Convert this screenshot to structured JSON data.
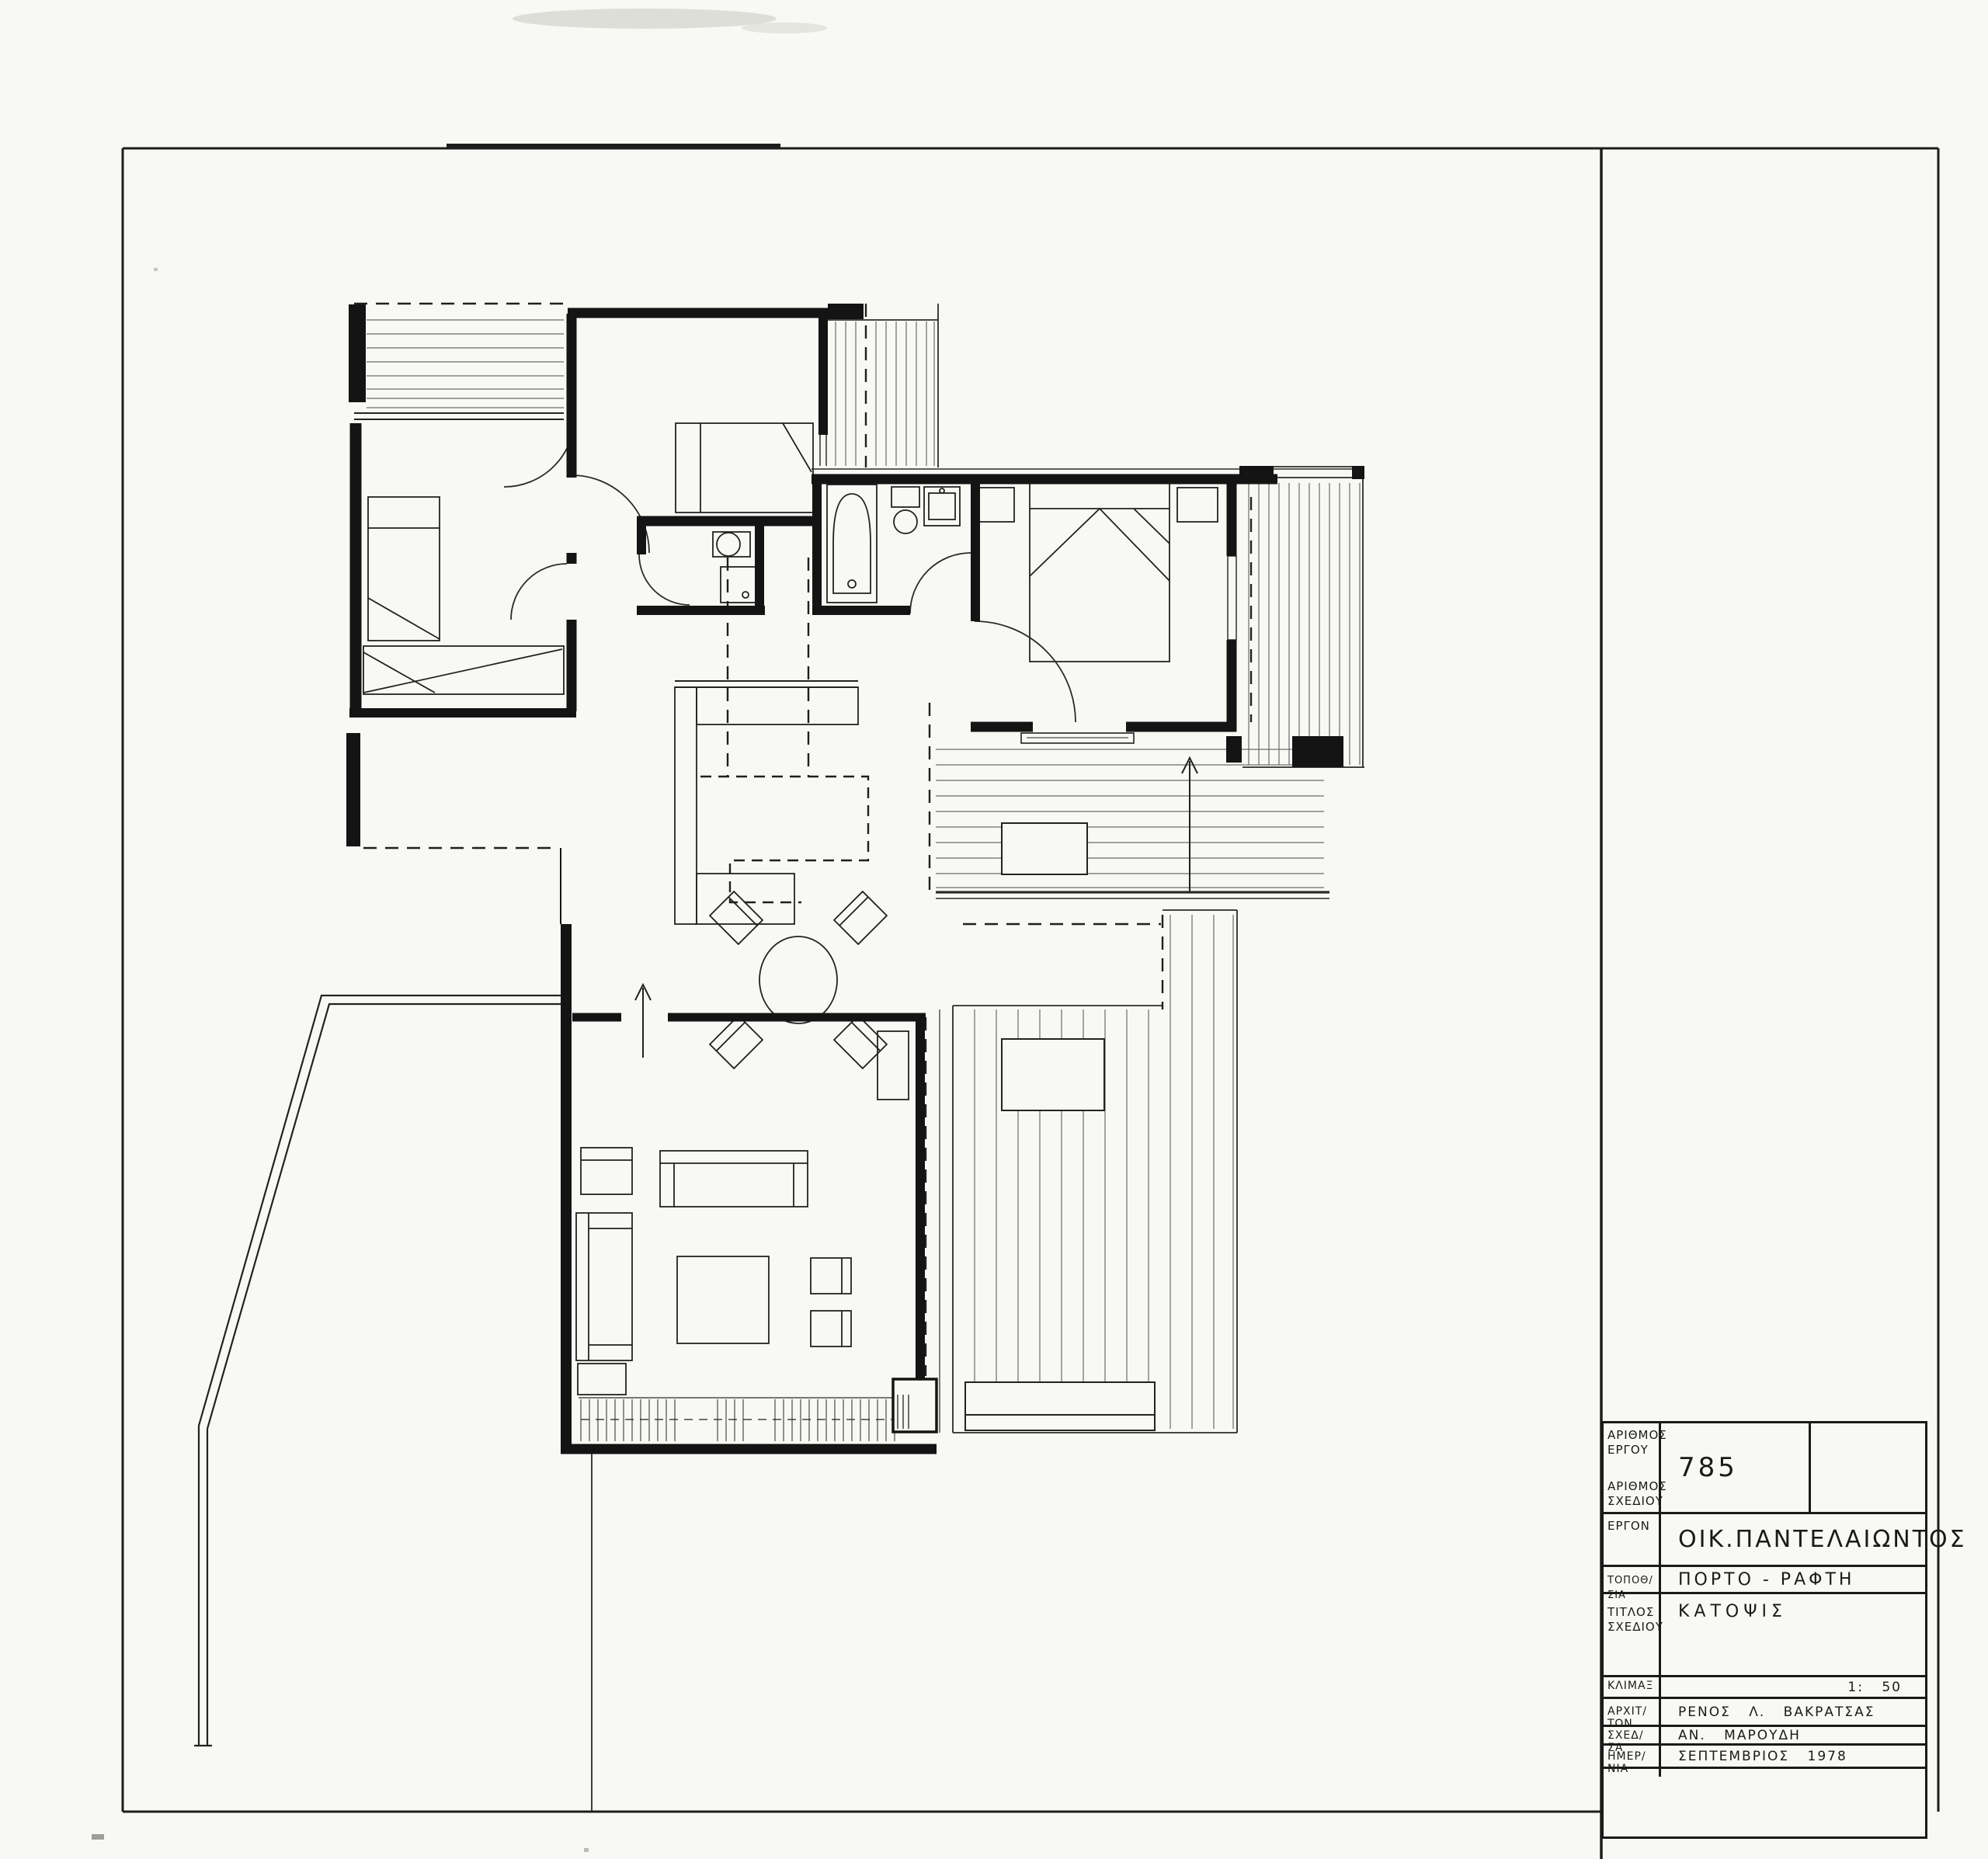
{
  "sheet": {
    "type_of_drawing": "architectural floor plan",
    "language": "Greek"
  },
  "colors": {
    "paper": "#f8f8f4",
    "ink": "#1a1a1a",
    "slat_line": "#6b6b6b"
  },
  "title_block": {
    "fields": [
      {
        "label_top": "ΑΡΙΘΜΟΣ ΕΡΓΟΥ",
        "label_bottom": "ΑΡΙΘΜΟΣ ΣΧΕΔΙΟΥ",
        "value": "785"
      },
      {
        "label": "ΕΡΓΟΝ",
        "value": "ΟΙΚ.ΠΑΝΤΕΛΑΙΩΝΤΟΣ"
      },
      {
        "label": "ΤΟΠΟΘ/ΣΙΑ",
        "value": "ΠΟΡΤΟ - ΡΑΦΤΗ"
      },
      {
        "label": "ΤΙΤΛΟΣ ΣΧΕΔΙΟΥ",
        "value": "ΚΑΤΟΨΙΣ"
      },
      {
        "label": "ΚΛΙΜΑΞ",
        "value": "1: 50"
      },
      {
        "label": "ΑΡΧΙΤ/ΤΩΝ",
        "value": "ΡΕΝΟΣ Λ. ΒΑΚΡΑΤΣΑΣ"
      },
      {
        "label": "ΣΧΕΔ/ΣΑ",
        "value": "ΑΝ. ΜΑΡΟΥΔΗ"
      },
      {
        "label": "ΗΜΕΡ/ΝΙΑ",
        "value": "ΣΕΠΤΕΜΒΡΙΟΣ 1978"
      }
    ]
  }
}
